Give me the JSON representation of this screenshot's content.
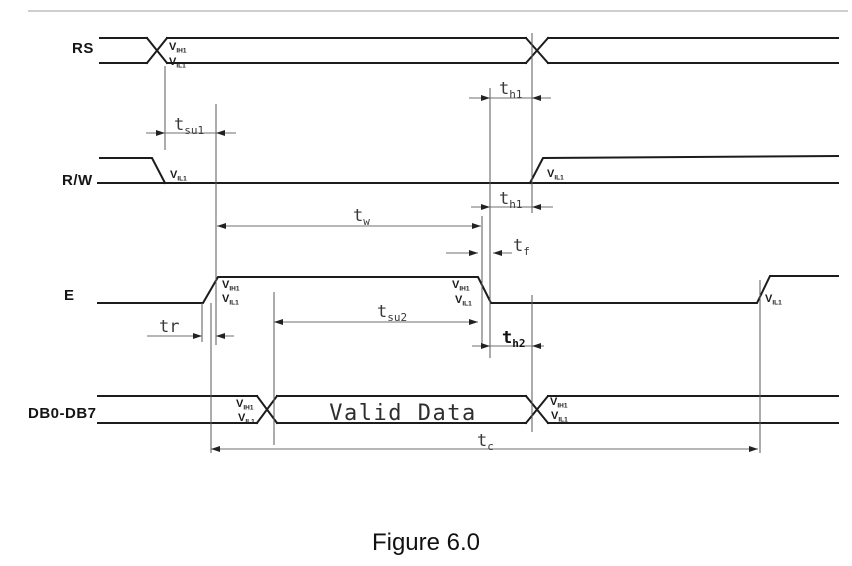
{
  "figure": {
    "caption": "Figure 6.0"
  },
  "signals": {
    "rs": "RS",
    "rw": "R/W",
    "e": "E",
    "db": "DB0-DB7"
  },
  "voltage_labels": {
    "v": "V",
    "ih1": "IH1",
    "il1": "IL1"
  },
  "timing_labels": {
    "t": "t",
    "su1": "su1",
    "h1": "h1",
    "w": "w",
    "f": "f",
    "su2": "su2",
    "r": "r",
    "h2": "h2",
    "c": "c"
  },
  "bus_text": {
    "valid_data": "Valid Data"
  },
  "diagram": {
    "type": "timing-diagram",
    "description": "Bus write timing: RS and R/W set up tsu1 before E rising edge; E high pulse width tw with rise tr and fall tf; data DB0-DB7 valid tsu2 before E falling edge, held th2 after; RS and R/W held th1 after E falls; total cycle time tc.",
    "timing_parameters_shown": [
      "tsu1",
      "th1",
      "tw",
      "tf",
      "tsu2",
      "tr",
      "th2",
      "tc"
    ]
  },
  "colors": {
    "signal_line": "#1c1c1c",
    "dimension_line": "#6f6f6f",
    "background": "#ffffff",
    "text": "#141414"
  }
}
